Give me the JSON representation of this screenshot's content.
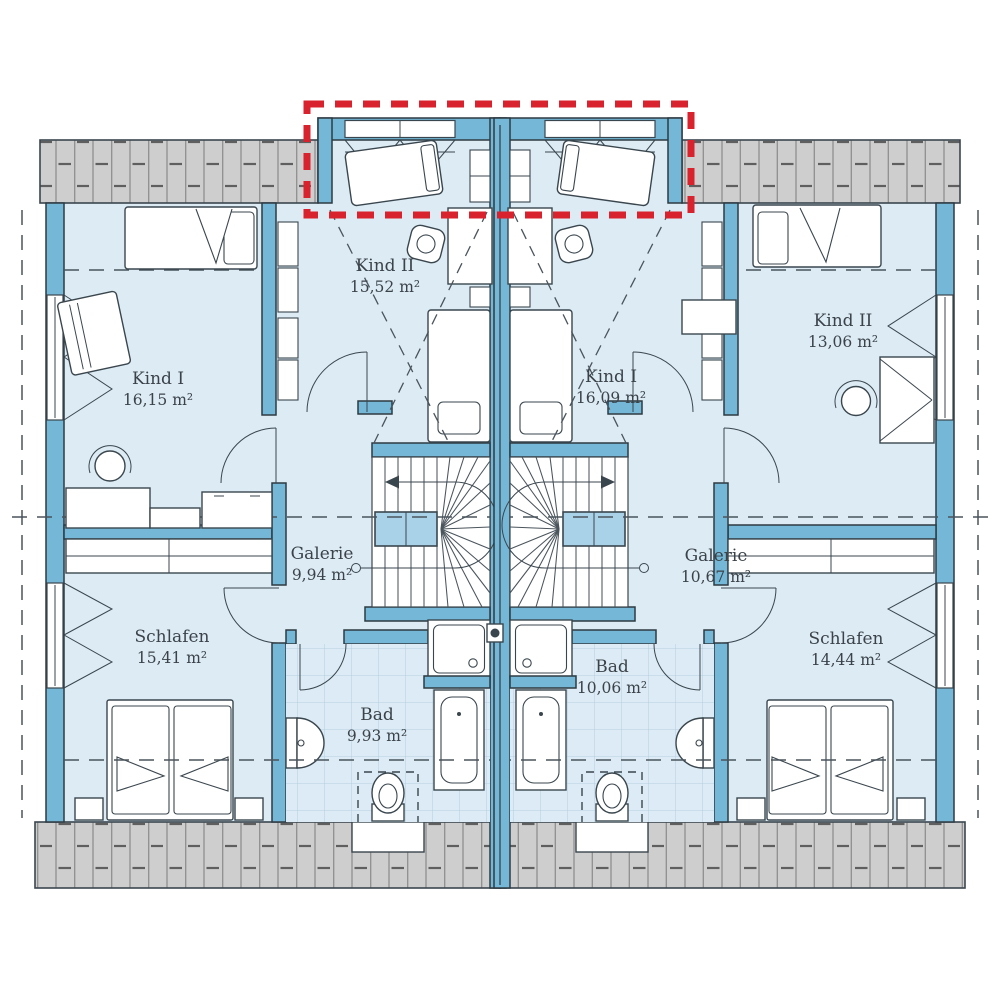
{
  "colors": {
    "wall_blue": "#74b7d6",
    "room_fill": "#ddebf5",
    "roof_gray": "#cecece",
    "bath_tile": "#dcebf5",
    "stair_void_blue": "#a9d2e8",
    "highlight_red": "#d8232e",
    "line_dark": "#3a464e"
  },
  "units": {
    "left": {
      "rooms": {
        "kind1": {
          "name": "Kind I",
          "area": "16,15 m²"
        },
        "kind2": {
          "name": "Kind II",
          "area": "15,52 m²"
        },
        "galerie": {
          "name": "Galerie",
          "area": "9,94 m²"
        },
        "schlafen": {
          "name": "Schlafen",
          "area": "15,41 m²"
        },
        "bad": {
          "name": "Bad",
          "area": "9,93 m²"
        }
      }
    },
    "right": {
      "rooms": {
        "kind1": {
          "name": "Kind I",
          "area": "16,09 m²"
        },
        "kind2": {
          "name": "Kind II",
          "area": "13,06 m²"
        },
        "galerie": {
          "name": "Galerie",
          "area": "10,67 m²"
        },
        "schlafen": {
          "name": "Schlafen",
          "area": "14,44 m²"
        },
        "bad": {
          "name": "Bad",
          "area": "10,06 m²"
        }
      }
    }
  }
}
